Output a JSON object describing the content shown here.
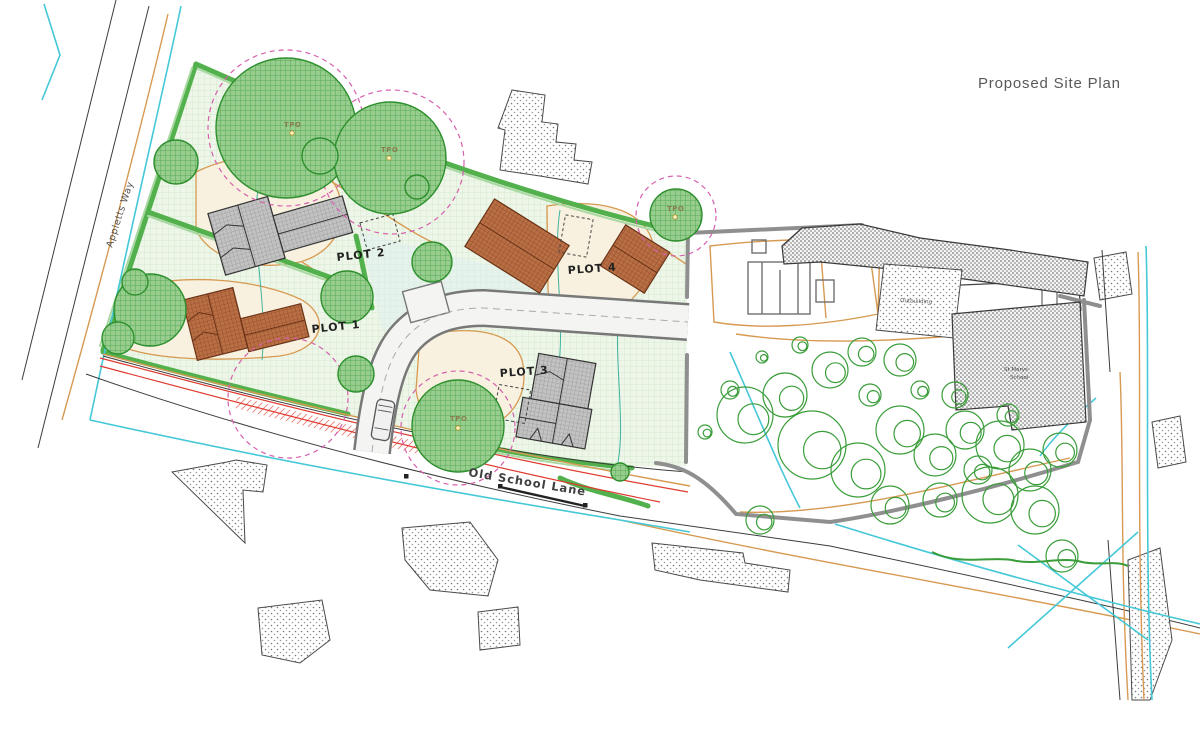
{
  "title": "Proposed Site Plan",
  "labels": {
    "plots": [
      {
        "id": "plot-1",
        "text": "PLOT 1"
      },
      {
        "id": "plot-2",
        "text": "PLOT 2"
      },
      {
        "id": "plot-3",
        "text": "PLOT 3"
      },
      {
        "id": "plot-4",
        "text": "PLOT 4"
      }
    ],
    "roads": {
      "old_school_lane": "Old School Lane",
      "appletts_way": "Appletts Way"
    },
    "tpo": "TPO",
    "outbuilding": "Outbuilding",
    "st_marys_line1": "St Marys",
    "st_marys_line2": "School"
  },
  "colors": {
    "tree_green": "#8cc786",
    "tree_stroke": "#2e8f2e",
    "hedge_green": "#52b14c",
    "site_lawn": "#edf6e8",
    "garden_cream": "#f8f1df",
    "plot_boundary_orange": "#d79a52",
    "roof_gray": "#c2c2c2",
    "roof_brown": "#b96f44",
    "road_red": "#df3a2e",
    "water_cyan": "#45c8d8",
    "rpa_pink": "#d65fae",
    "ownership_boundary_gray": "#8f8f8f",
    "title_gray": "#595959"
  },
  "trees": {
    "preserved": [
      {
        "cx": 286,
        "cy": 128,
        "r": 70
      },
      {
        "cx": 390,
        "cy": 158,
        "r": 56
      },
      {
        "cx": 320,
        "cy": 156,
        "r": 18
      },
      {
        "cx": 176,
        "cy": 162,
        "r": 22
      },
      {
        "cx": 150,
        "cy": 310,
        "r": 36
      },
      {
        "cx": 118,
        "cy": 338,
        "r": 16
      },
      {
        "cx": 135,
        "cy": 282,
        "r": 13
      },
      {
        "cx": 347,
        "cy": 297,
        "r": 26
      },
      {
        "cx": 432,
        "cy": 262,
        "r": 20
      },
      {
        "cx": 417,
        "cy": 187,
        "r": 12
      },
      {
        "cx": 356,
        "cy": 374,
        "r": 18
      },
      {
        "cx": 458,
        "cy": 426,
        "r": 46
      },
      {
        "cx": 676,
        "cy": 215,
        "r": 26
      },
      {
        "cx": 620,
        "cy": 472,
        "r": 9
      }
    ],
    "rpa": [
      {
        "cx": 286,
        "cy": 128,
        "r": 78
      },
      {
        "cx": 392,
        "cy": 162,
        "r": 72
      },
      {
        "cx": 676,
        "cy": 216,
        "r": 40
      },
      {
        "cx": 458,
        "cy": 428,
        "r": 57
      },
      {
        "cx": 288,
        "cy": 398,
        "r": 60
      }
    ],
    "garden": [
      [
        745,
        415,
        28
      ],
      [
        785,
        395,
        22
      ],
      [
        830,
        370,
        18
      ],
      [
        862,
        352,
        14
      ],
      [
        900,
        360,
        16
      ],
      [
        812,
        445,
        34
      ],
      [
        858,
        470,
        27
      ],
      [
        900,
        430,
        24
      ],
      [
        935,
        455,
        21
      ],
      [
        965,
        430,
        19
      ],
      [
        1000,
        445,
        24
      ],
      [
        1030,
        470,
        21
      ],
      [
        890,
        505,
        19
      ],
      [
        940,
        500,
        17
      ],
      [
        760,
        520,
        14
      ],
      [
        990,
        495,
        28
      ],
      [
        1035,
        510,
        24
      ],
      [
        1060,
        450,
        17
      ],
      [
        870,
        395,
        11
      ],
      [
        920,
        390,
        9
      ],
      [
        955,
        395,
        13
      ],
      [
        730,
        390,
        9
      ],
      [
        705,
        432,
        7
      ],
      [
        978,
        470,
        14
      ],
      [
        1008,
        415,
        11
      ],
      [
        800,
        345,
        8
      ],
      [
        762,
        357,
        6
      ],
      [
        1062,
        556,
        16
      ]
    ]
  }
}
